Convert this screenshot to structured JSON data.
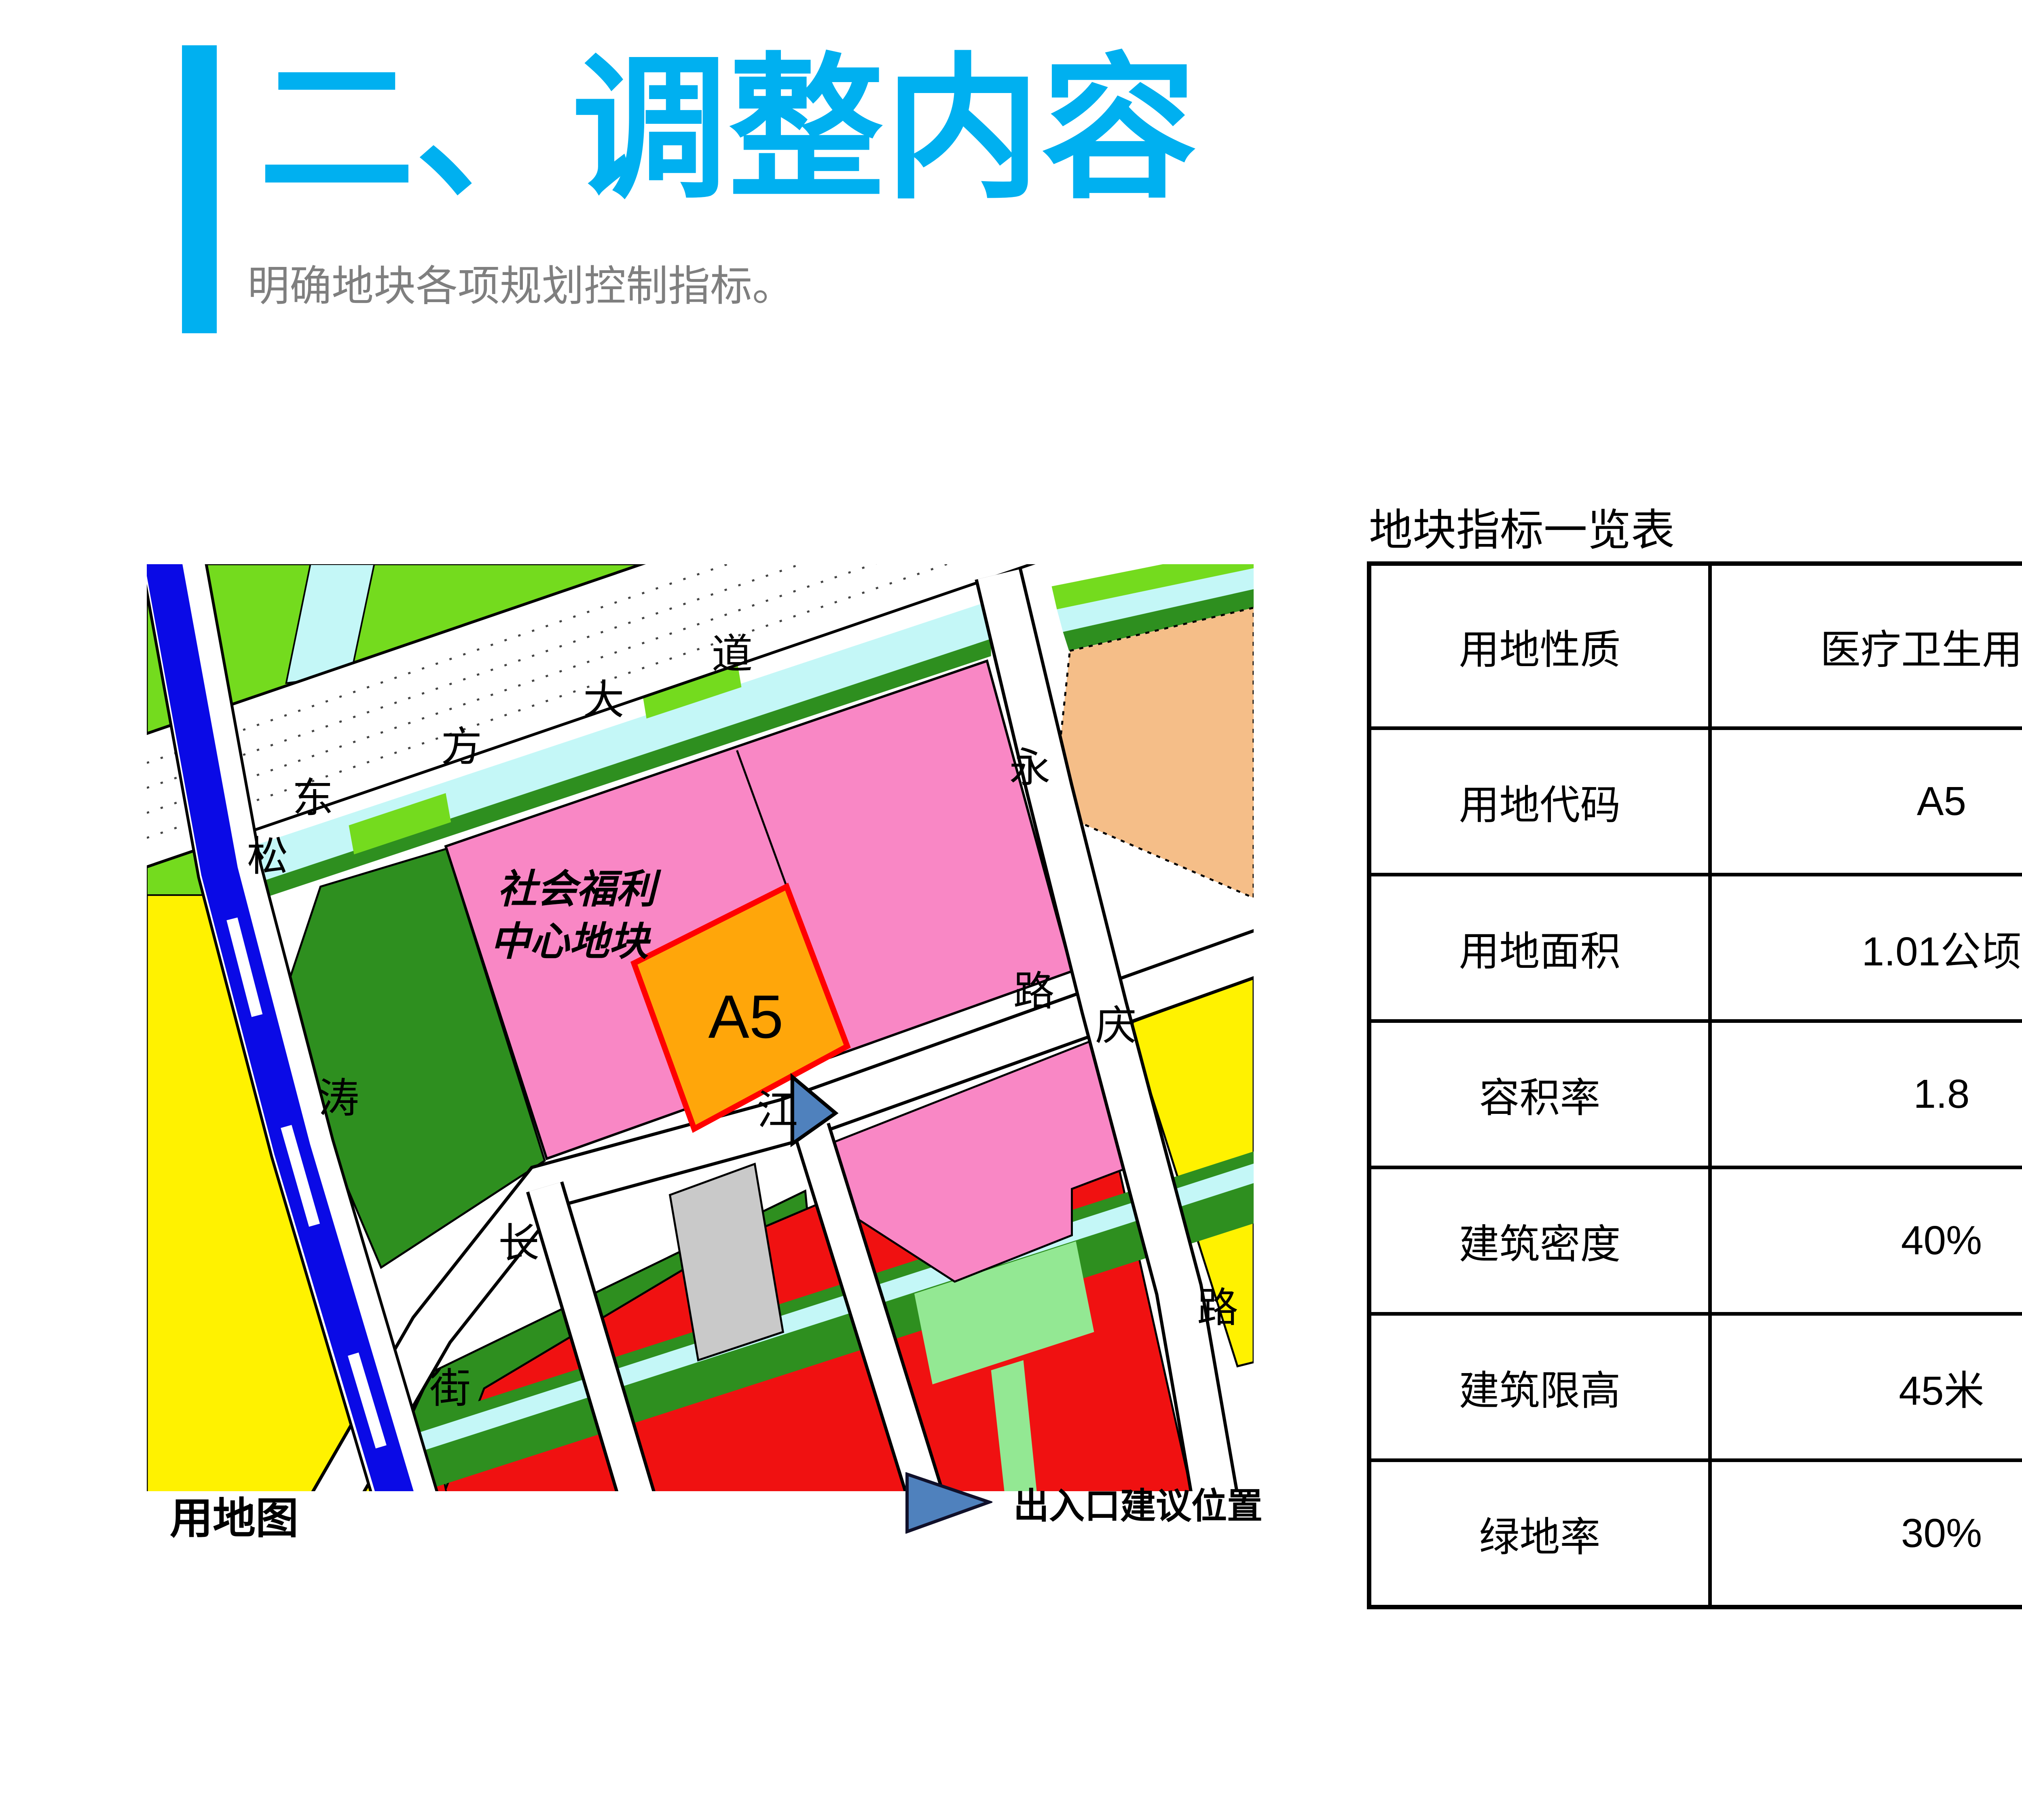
{
  "slide": {
    "title": "二、调整内容",
    "subtitle": "明确地块各项规划控制指标。",
    "page_number": "46",
    "accent_color": "#00B0F0"
  },
  "map": {
    "caption": "用地图",
    "parcel_label_line1": "社会福利",
    "parcel_label_line2": "中心地块",
    "parcel_code": "A5",
    "legend": {
      "label": "出入口建议位置",
      "marker": "entrance-arrow-triangle",
      "marker_color": "#4F81BD"
    },
    "road_labels": {
      "dongfang_avenue": [
        "东",
        "方",
        "大",
        "道"
      ],
      "songtao_street": [
        "松",
        "涛",
        "街"
      ],
      "changjiang_road": [
        "长",
        "江",
        "路"
      ],
      "yongqing_road": [
        "永",
        "庆",
        "路"
      ]
    },
    "colors": {
      "bright_green": "#74DB1E",
      "dark_green": "#2E8F1F",
      "light_cyan": "#C4F7F7",
      "canal_blue": "#0A0AE6",
      "pink": "#F987C5",
      "orange_parcel": "#FFA60A",
      "parcel_border_red": "#FF0000",
      "peach": "#F5BE88",
      "yellow": "#FFF200",
      "red": "#F01111",
      "light_green": "#93E893",
      "gray": "#C9C9C9",
      "road_white": "#FFFFFF",
      "marker_blue": "#4F81BD"
    }
  },
  "table": {
    "title": "地块指标一览表",
    "rows": [
      {
        "label": "用地性质",
        "value": "医疗卫生用地"
      },
      {
        "label": "用地代码",
        "value": "A5"
      },
      {
        "label": "用地面积",
        "value": "1.01公顷"
      },
      {
        "label": "容积率",
        "value": "1.8"
      },
      {
        "label": "建筑密度",
        "value": "40%"
      },
      {
        "label": "建筑限高",
        "value": "45米"
      },
      {
        "label": "绿地率",
        "value": "30%"
      }
    ]
  }
}
